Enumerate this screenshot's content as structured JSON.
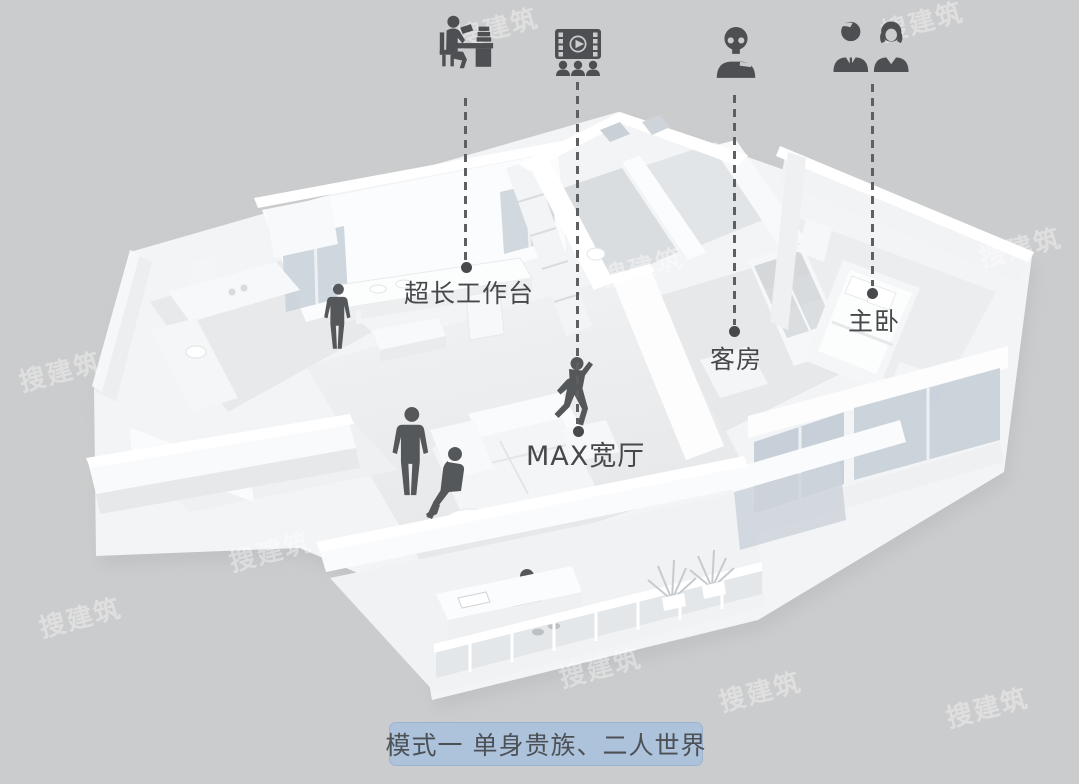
{
  "colors": {
    "background": "#cbcccd",
    "model_white": "#f4f5f7",
    "glass": "#c4cdd6",
    "figure": "#55585b",
    "icon": "#4d4f52",
    "leader_line": "#5d5f61",
    "label_text": "#46484b",
    "caption_background": "#adc3dc",
    "caption_text": "#4d5156"
  },
  "annotations": {
    "items": [
      {
        "icon": "reading-desk-icon",
        "label": "超长工作台"
      },
      {
        "icon": "home-theater-icon",
        "label": "MAX宽厅"
      },
      {
        "icon": "single-person-icon",
        "label": "客房"
      },
      {
        "icon": "couple-icon",
        "label": "主卧"
      }
    ]
  },
  "caption": {
    "text": "模式一  单身贵族、二人世界"
  },
  "watermark": {
    "text": "搜建筑"
  }
}
